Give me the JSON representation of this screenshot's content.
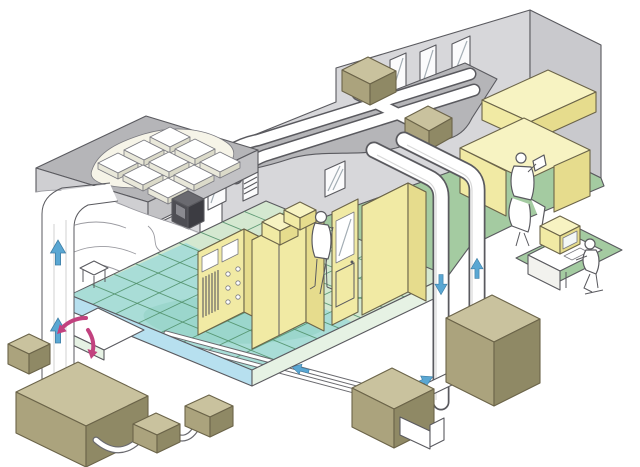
{
  "palette": {
    "background": "#ffffff",
    "outline": "#5a5a5f",
    "wall": "#d7d7da",
    "wall_shadow": "#c9c9cd",
    "roof_top": "#b5b5b8",
    "roof_side": "#cfcfd2",
    "roof_side_b": "#c2c2c5",
    "hole_bg": "#f6f4e8",
    "tile_top": "#ffffff",
    "tile_left": "#e9e8da",
    "tile_right": "#dcdbca",
    "window": "#fbfbfc",
    "floor_green": "#a4cba1",
    "grid_floor": "#d4e8d0",
    "grid_patch": "#7fbc8e",
    "plenum_teal": "#9edad8",
    "edge_blue": "#b7e0ef",
    "edge_pale": "#e6f2e4",
    "yellow_top": "#f7f3c2",
    "yellow": "#f1eaa4",
    "yellow_side": "#e6dc8d",
    "khaki_top": "#c9c29e",
    "khaki_front": "#aba37d",
    "khaki_side": "#8f8965",
    "dark_box_top": "#6a6a70",
    "dark_box_front": "#4e4e54",
    "dark_box_side": "#3c3c42",
    "dark_box_inner": "#8a8a90",
    "duct": "#ffffff",
    "ledge": "#ffffff",
    "arrow_blue": "#5aa7d3",
    "arrow_pink": "#c2427f",
    "figure": "#ffffff",
    "screen": "#f3f7f7"
  },
  "scene": {
    "type": "isometric-cutaway-illustration",
    "subject": "cleanroom-building-air-circulation-system",
    "rooms": [
      {
        "name": "filter-plenum-room",
        "features": [
          "ceiling-hepa-filter-grid",
          "wall-control-box",
          "return-air-riser-duct"
        ]
      },
      {
        "name": "cleanroom",
        "features": [
          "raised-grid-floor",
          "underfloor-plenum",
          "process-cabinets",
          "air-shower-door",
          "standing-operator"
        ]
      },
      {
        "name": "office",
        "features": [
          "window-wall",
          "corner-workstation",
          "seated-worker"
        ]
      }
    ],
    "rooftop": {
      "duct_runs": 2,
      "fan_units": 2,
      "junction": "cross"
    },
    "risers": {
      "front_down_duct": 1,
      "front_up_duct": 1,
      "left_up_duct": 1
    },
    "ground_equipment_units": 8,
    "monitoring_station": [
      "desk",
      "crt-monitor",
      "keyboard",
      "seated-operator",
      "floor-mat"
    ],
    "airflow_arrows": {
      "blue": [
        {
          "location": "left-riser-duct",
          "direction": "up",
          "count": 2
        },
        {
          "location": "front-left-riser",
          "direction": "down",
          "count": 1
        },
        {
          "location": "front-right-riser",
          "direction": "up",
          "count": 1
        },
        {
          "location": "ground-connector-duct",
          "direction": "up-right",
          "count": 1
        },
        {
          "location": "underfloor-return-pipe",
          "direction": "left",
          "count": 1
        }
      ],
      "pink": [
        {
          "location": "underfloor-plenum",
          "direction": "swirl-left"
        },
        {
          "location": "underfloor-plenum",
          "direction": "swirl-down"
        }
      ]
    },
    "people_count": 3
  }
}
